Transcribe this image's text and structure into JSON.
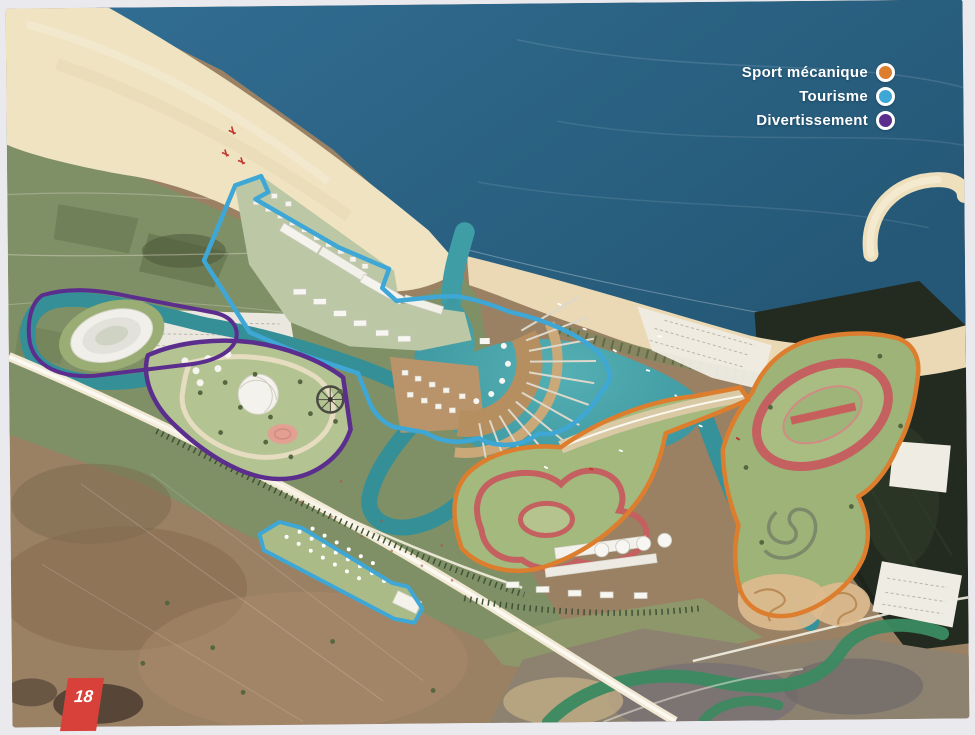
{
  "legend": {
    "items": [
      {
        "id": "sport-mecanique",
        "label": "Sport mécanique",
        "color": "#DD7E2E"
      },
      {
        "id": "tourisme",
        "label": "Tourisme",
        "color": "#3FA7D6"
      },
      {
        "id": "divertissement",
        "label": "Divertissement",
        "color": "#5B2E8E"
      }
    ]
  },
  "page": {
    "number": "18",
    "tab_color": "#D8403A"
  },
  "map_colors": {
    "ocean": "#2B6386",
    "sand": "#EFE3C2",
    "lagoon": "#3F9DA5",
    "terrain_green": "#7F9066",
    "terrain_brown": "#9A8164",
    "race_track_red": "#C4605F",
    "dark_wetland": "#232A20"
  }
}
